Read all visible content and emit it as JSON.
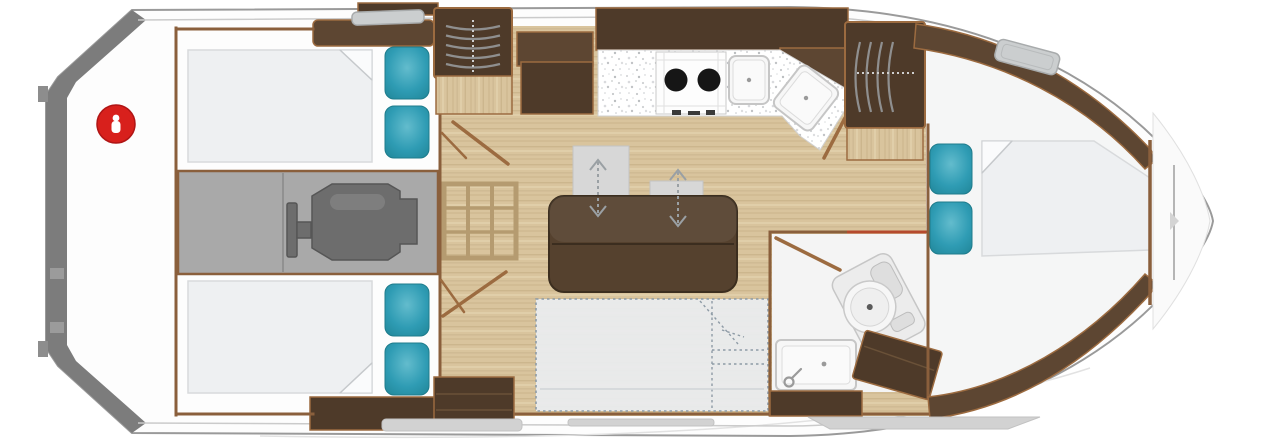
{
  "diagram": {
    "kind": "boat-floorplan",
    "orientation": "bow-right-stern-left"
  },
  "areas": [
    {
      "id": "swim-platform"
    },
    {
      "id": "aft-deck"
    },
    {
      "id": "aft-cabin-port"
    },
    {
      "id": "engine-room"
    },
    {
      "id": "aft-cabin-starboard"
    },
    {
      "id": "salon"
    },
    {
      "id": "galley"
    },
    {
      "id": "head"
    },
    {
      "id": "bow-cabin"
    },
    {
      "id": "foredeck"
    }
  ],
  "icons": [
    {
      "name": "red-circle-marker"
    },
    {
      "name": "companionway-steps"
    },
    {
      "name": "bow-steps"
    },
    {
      "name": "engine"
    },
    {
      "name": "stove-two-burner"
    },
    {
      "name": "sink-basin"
    },
    {
      "name": "corner-sink-basin"
    },
    {
      "name": "toilet"
    },
    {
      "name": "wash-basin"
    },
    {
      "name": "pillow"
    },
    {
      "name": "mattress"
    },
    {
      "name": "slide-arrow"
    },
    {
      "name": "floor-hatch-grate"
    },
    {
      "name": "deck-hatch"
    },
    {
      "name": "convertible-berth-outline"
    },
    {
      "name": "anchor-locker"
    }
  ],
  "colors": {
    "hull_fill": "#fdfdfd",
    "hull_outline": "#9a9a9a",
    "sheer_line": "#cbcbcb",
    "transom_gray": "#7c7c7c",
    "deck_white": "#f9f9f9",
    "wood_floor": "#d9c49d",
    "wood_streak_dark": "#bfa77e",
    "wood_streak_light": "#e9dbba",
    "wall_brown": "#8a5f3c",
    "cabinet_dark": "#4e3a29",
    "cabinet_mid": "#5d4632",
    "cabinet_edge": "#9c6b40",
    "mattress_white": "#eef0f2",
    "mattress_edge": "#d8dadc",
    "pillow_teal": "#2f9cb4",
    "pillow_teal_light": "#63bccd",
    "engine_room_gray": "#a9a9a9",
    "engine_gray": "#6d6d6d",
    "engine_dark": "#565656",
    "counter_white": "#ffffff",
    "speckle_gray": "#b9bcc0",
    "burner_black": "#161616",
    "fixture_white": "#f7f7f7",
    "table_brown": "#55412e",
    "table_edge": "#3c2e1f",
    "gray_square": "#d7d7d7",
    "arrow_gray": "#9aa0a4",
    "berth_fill": "#e9edf0",
    "berth_dash": "#8e9ba6",
    "bath_floor": "#f4f4f4",
    "accent_red_line": "#b54a2e",
    "badge_red": "#d8201c",
    "hatch_gray": "#cbcecf",
    "platform_step_gray": "#d2d2d2"
  }
}
